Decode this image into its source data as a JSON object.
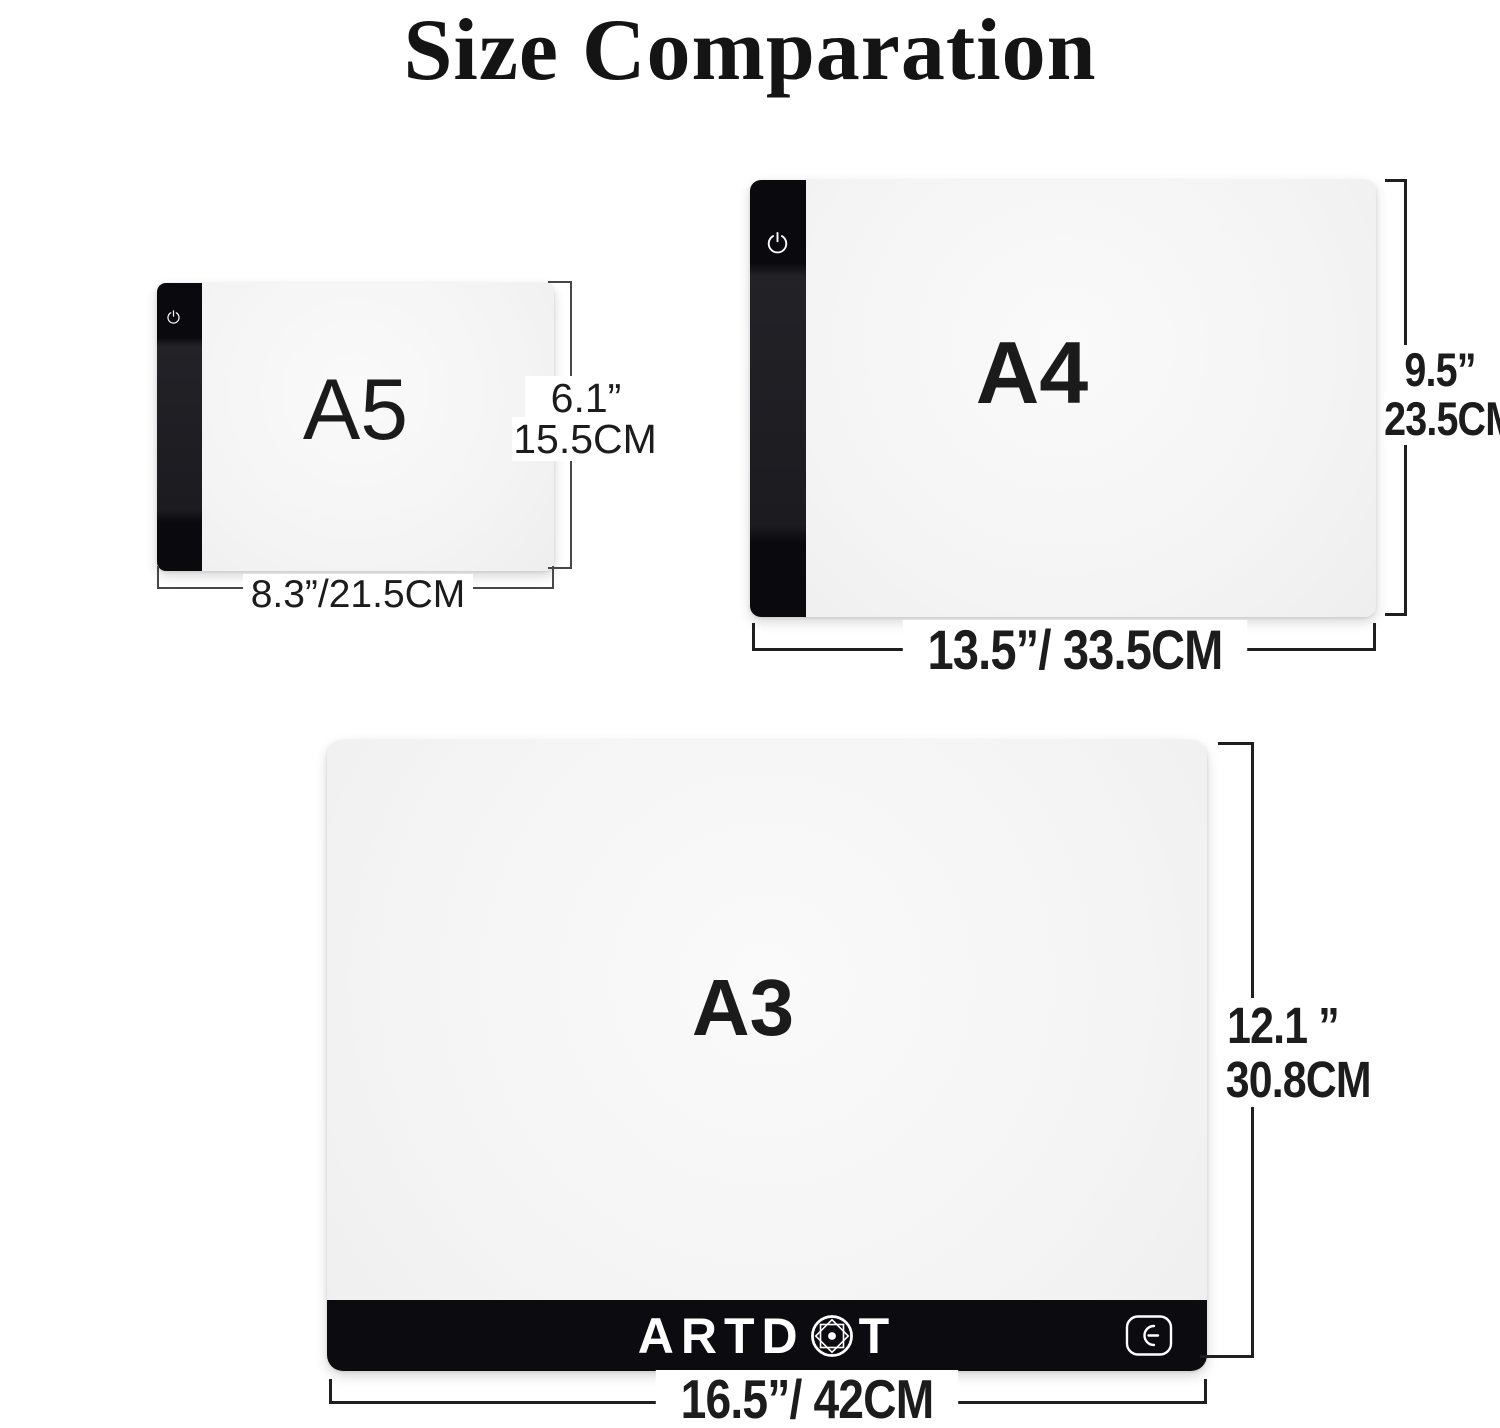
{
  "title": "Size Comparation",
  "pads": {
    "a5": {
      "name": "A5",
      "height_in": "6.1”",
      "height_cm": "15.5CM",
      "width_label": "8.3”/21.5CM",
      "power_icon": "power-icon"
    },
    "a4": {
      "name": "A4",
      "height_in": "9.5”",
      "height_cm": "23.5CM",
      "width_label": "13.5”/ 33.5CM",
      "power_icon": "power-icon"
    },
    "a3": {
      "name": "A3",
      "height_in": "12.1 ”",
      "height_cm": "30.8CM",
      "width_label": "16.5”/ 42CM",
      "brand_prefix": "ARTD",
      "brand_suffix": "T",
      "brand_gem_icon": "gem-icon",
      "power_icon": "power-button-icon"
    }
  },
  "colors": {
    "pad_black": "#0b0b10",
    "dim_line_dark": "#1f1f1f",
    "dim_line_light": "#474747",
    "text": "#1c1c1c"
  }
}
